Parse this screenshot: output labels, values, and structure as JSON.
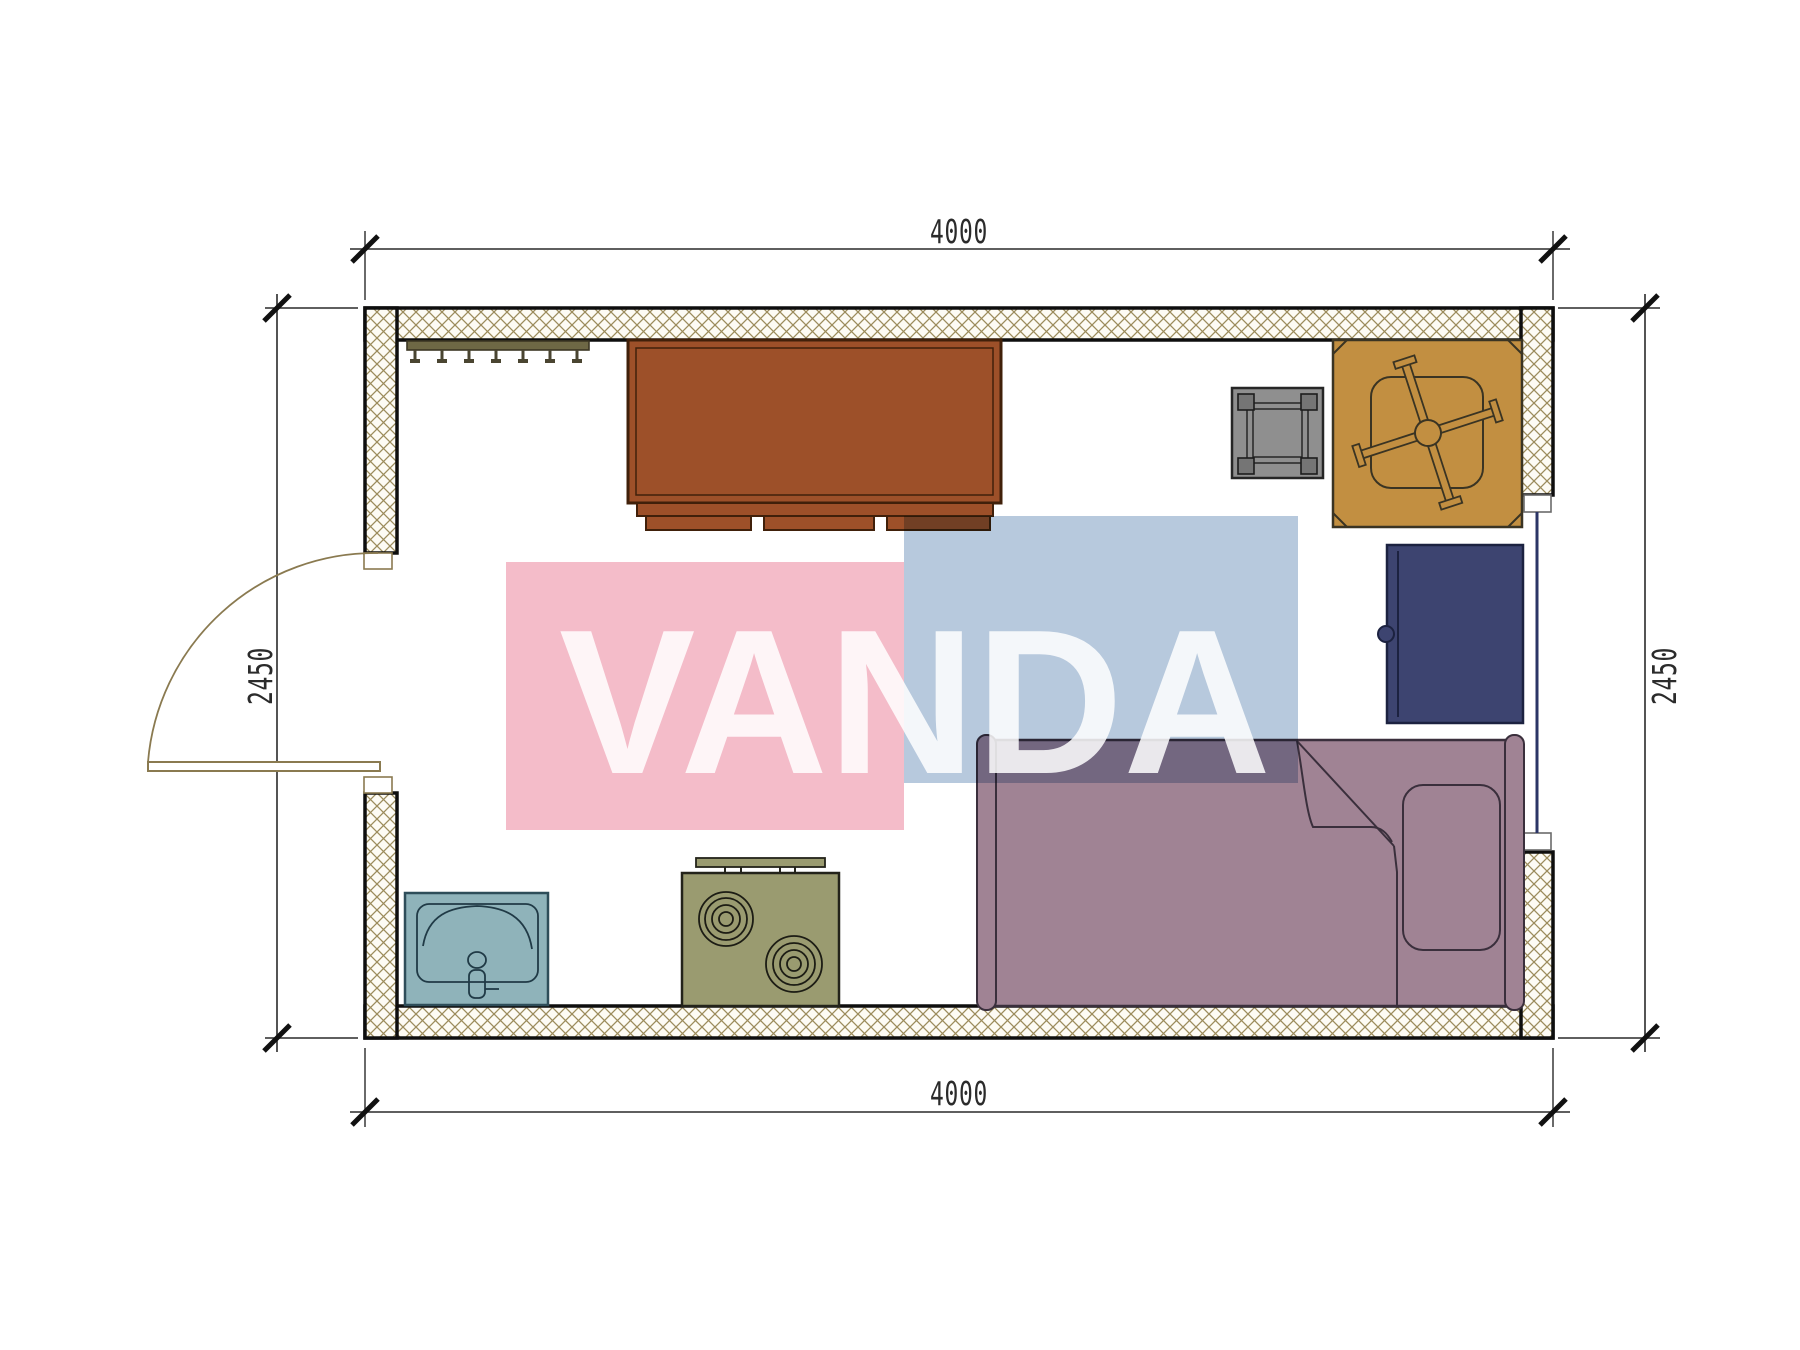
{
  "title": "cabin-floor-plan",
  "watermark": {
    "text": "VANDA",
    "pink": "#f4bcc9",
    "blue": "#b7c9dd",
    "text_fill": "rgba(255,255,255,0.85)"
  },
  "dimensions": {
    "top": "4000",
    "bottom": "4000",
    "left": "2450",
    "right": "2450"
  },
  "colors": {
    "wall_hatch": "#9c8c5c",
    "wall_hatch_bg": "#fdfbf4",
    "wall_line": "#0e0e0e",
    "desk": "#9d5029",
    "coat_rack": "#6e6845",
    "hook": "#4a4531",
    "stool": "#8f8f8f",
    "stool_leg": "#757575",
    "table": "#c28f41",
    "cabinet": "#3d4470",
    "bed": "#a08394",
    "sink": "#8fb3ba",
    "stove": "#9a9b70",
    "door": "#8a7a50",
    "window": "#2b3566",
    "white": "#ffffff"
  },
  "furniture_labels": {
    "coat_rack": "coat rack with hooks",
    "desk": "desk with drawers",
    "stool": "square stool",
    "table": "square table with cross base",
    "cabinet": "cabinet with door",
    "bed": "single bed with pillow and folded blanket",
    "sink": "wash basin",
    "stove": "two-burner stove",
    "door": "swing door",
    "window": "window"
  }
}
